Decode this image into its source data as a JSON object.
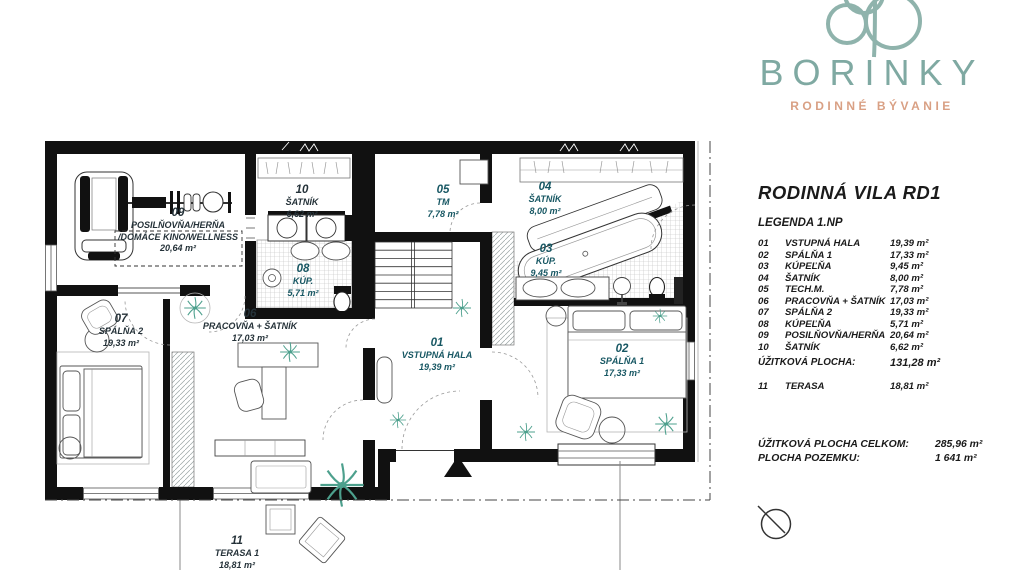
{
  "brand": {
    "name": "BORINKY",
    "tagline": "RODINNÉ BÝVANIE",
    "logo_color": "#7fa9a2",
    "tagline_color": "#d9a084"
  },
  "panel": {
    "title": "RODINNÁ VILA RD1",
    "legend_heading": "LEGENDA 1.NP",
    "legend": [
      {
        "num": "01",
        "name": "VSTUPNÁ HALA",
        "area": "19,39 m²"
      },
      {
        "num": "02",
        "name": "SPÁLŇA 1",
        "area": "17,33 m²"
      },
      {
        "num": "03",
        "name": "KÚPEĽŇA",
        "area": "9,45 m²"
      },
      {
        "num": "04",
        "name": "ŠATNÍK",
        "area": "8,00 m²"
      },
      {
        "num": "05",
        "name": "TECH.M.",
        "area": "7,78 m²"
      },
      {
        "num": "06",
        "name": "PRACOVŇA + ŠATNÍK",
        "area": "17,03 m²"
      },
      {
        "num": "07",
        "name": "SPÁLŇA 2",
        "area": "19,33 m²"
      },
      {
        "num": "08",
        "name": "KÚPEĽŇA",
        "area": "5,71 m²"
      },
      {
        "num": "09",
        "name": "POSILŇOVŇA/HERŇA",
        "area": "20,64 m²"
      },
      {
        "num": "10",
        "name": "ŠATNÍK",
        "area": "6,62 m²"
      }
    ],
    "subtotal_label": "ÚŽITKOVÁ PLOCHA:",
    "subtotal_value": "131,28 m²",
    "terrace": {
      "num": "11",
      "name": "TERASA",
      "area": "18,81 m²"
    },
    "total_label": "ÚŽITKOVÁ PLOCHA CELKOM:",
    "total_value": "285,96 m²",
    "plot_label": "PLOCHA POZEMKU:",
    "plot_value": "1 641 m²"
  },
  "plan": {
    "label_color_teal": "#175763",
    "label_color_dark": "#253239",
    "plant_color": "#4da08d",
    "rooms": [
      {
        "num": "01",
        "name": "VSTUPNÁ HALA",
        "area": "19,39 m²"
      },
      {
        "num": "02",
        "name": "SPÁLŇA 1",
        "area": "17,33 m²"
      },
      {
        "num": "03",
        "name": "KÚP.",
        "area": "9,45 m²"
      },
      {
        "num": "04",
        "name": "ŠATNÍK",
        "area": "8,00 m²"
      },
      {
        "num": "05",
        "name": "TM",
        "area": "7,78 m²"
      },
      {
        "num": "06",
        "name": "PRACOVŇA + ŠATNÍK",
        "area": "17,03 m²"
      },
      {
        "num": "07",
        "name": "SPÁLŇA 2",
        "area": "19,33 m²"
      },
      {
        "num": "08",
        "name": "KÚP.",
        "area": "5,71 m²"
      },
      {
        "num": "09",
        "name": "POSILŇOVŇA/HERŇA\n/DOMÁCE KINO/WELLNESS",
        "area": "20,64 m²"
      },
      {
        "num": "10",
        "name": "ŠATNÍK",
        "area": "6,62 m²"
      },
      {
        "num": "11",
        "name": "TERASA 1",
        "area": "18,81 m²"
      }
    ]
  }
}
